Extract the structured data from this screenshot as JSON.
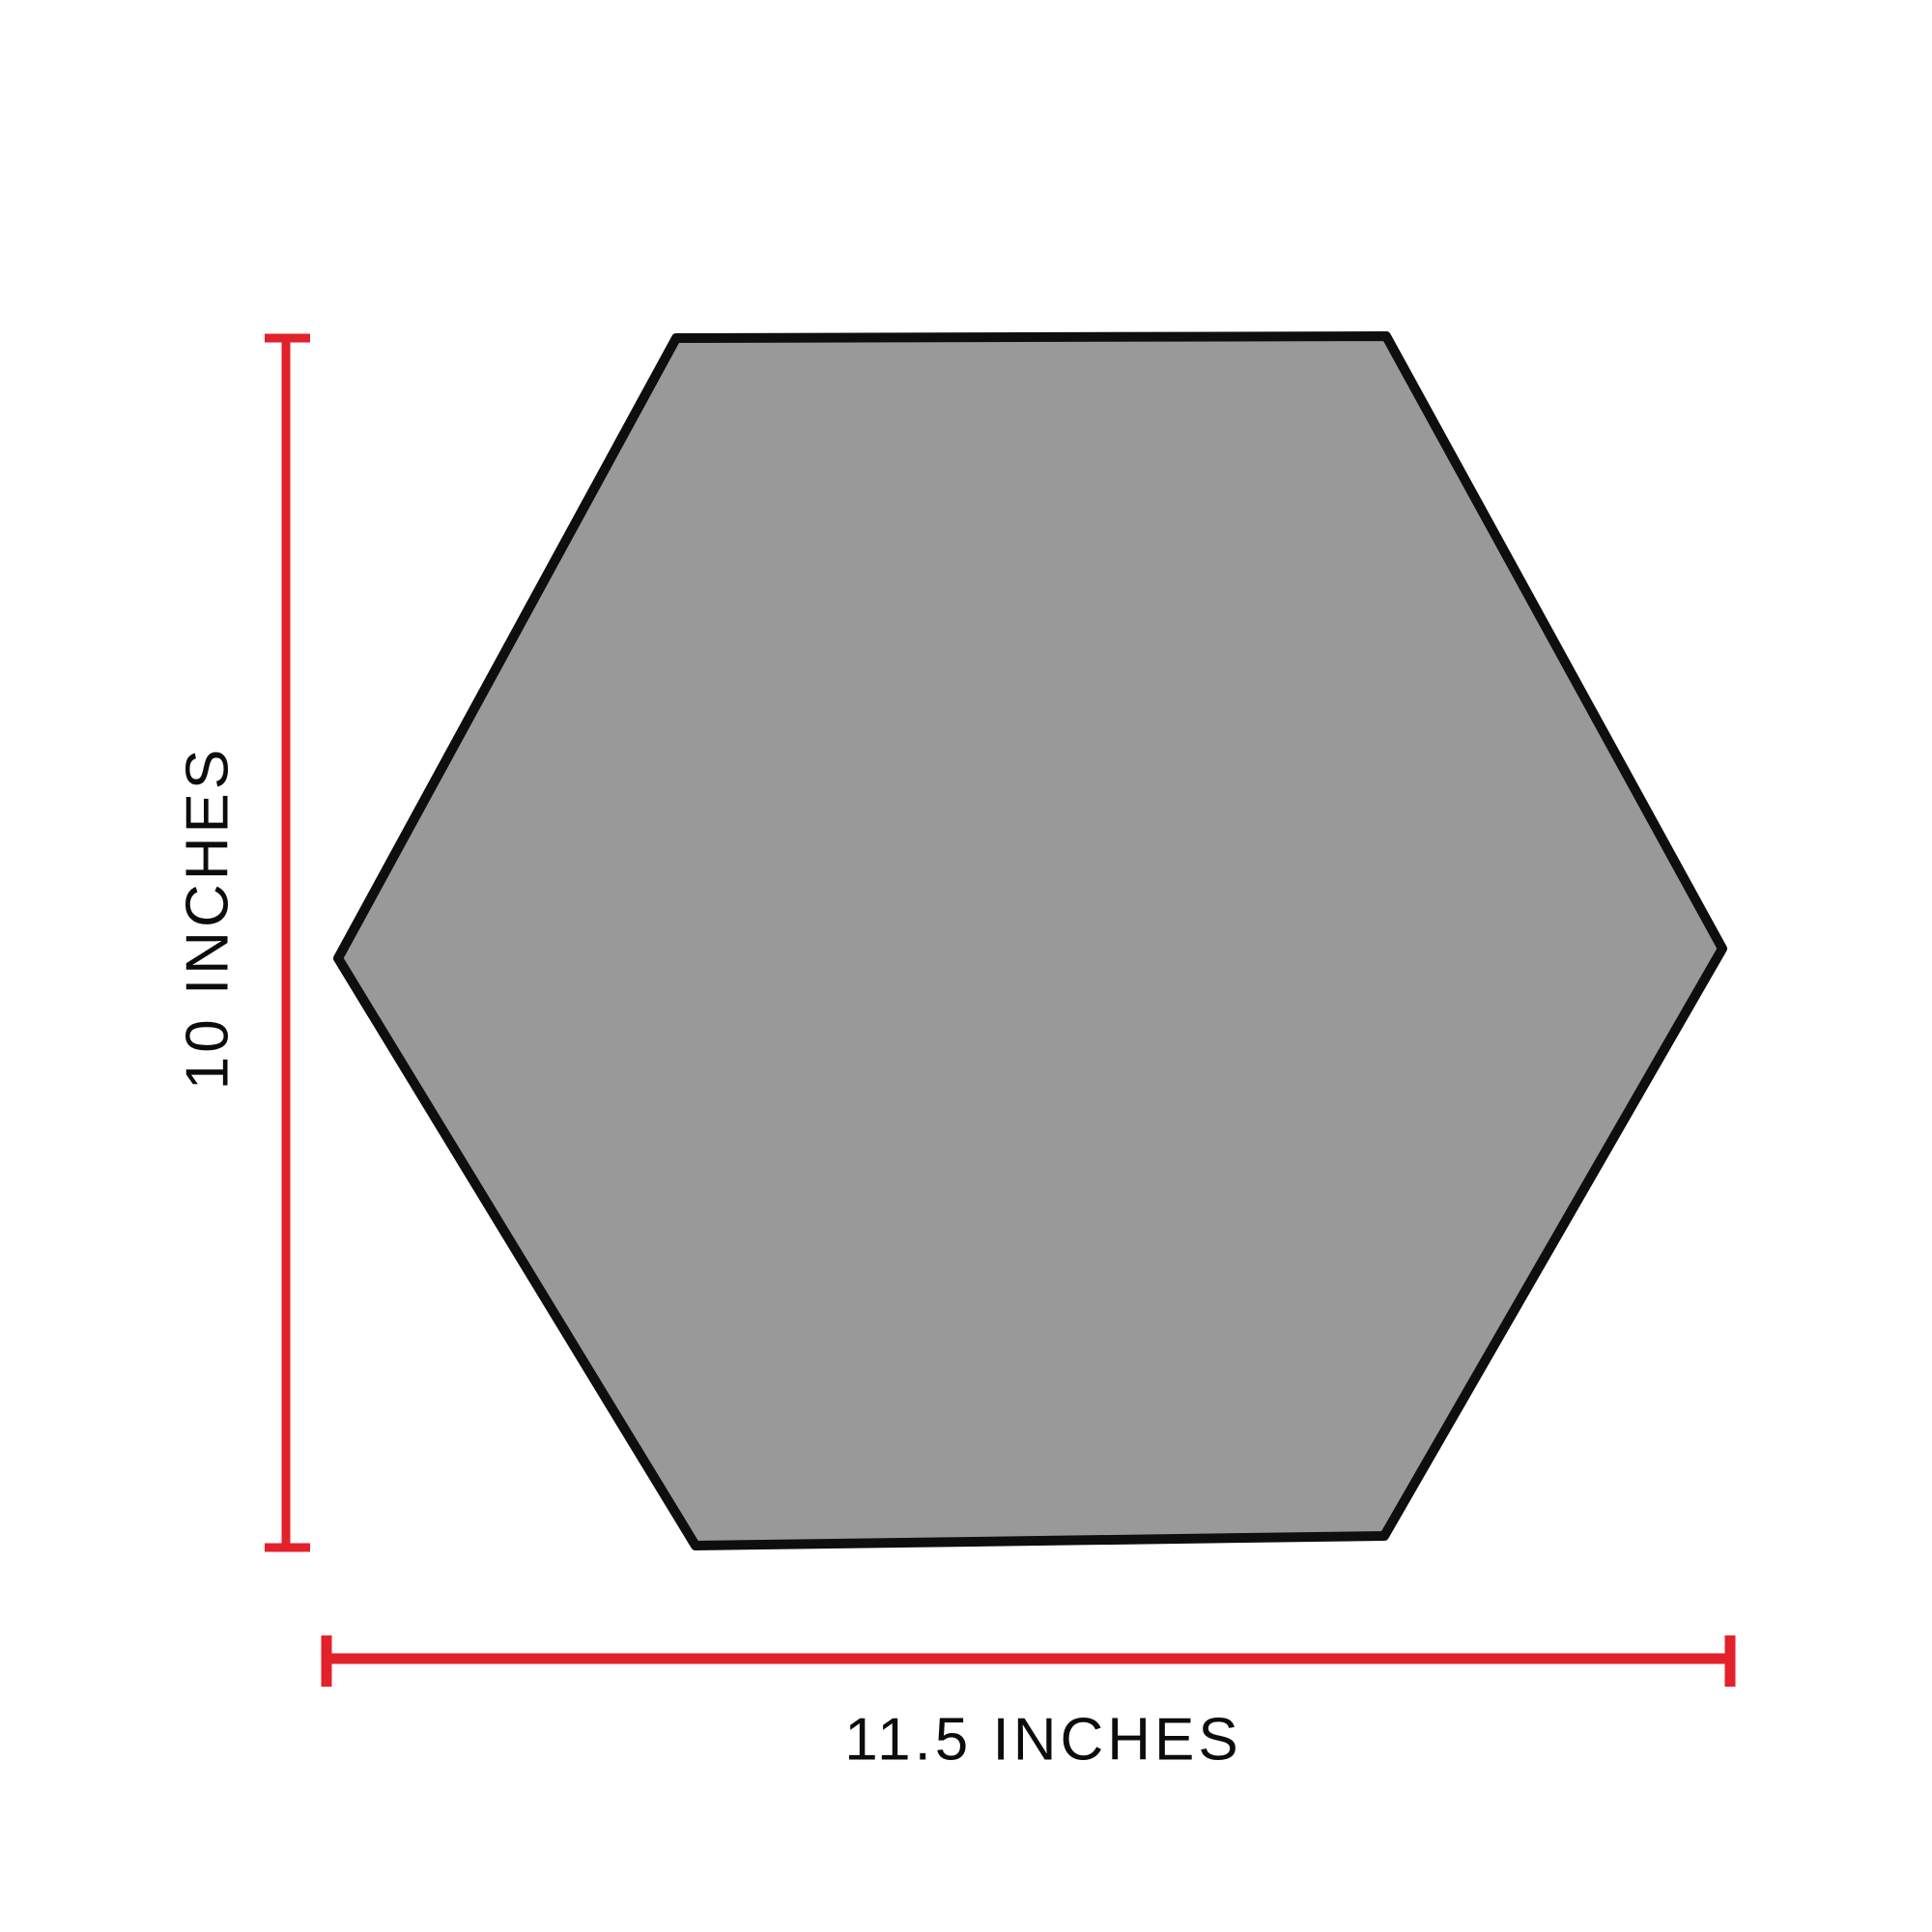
{
  "figure": {
    "shape_name": "hexagon",
    "height_dimension": {
      "label": "10 INCHES",
      "value_inches": 10
    },
    "width_dimension": {
      "label": "11.5 INCHES",
      "value_inches": 11.5
    }
  },
  "colors": {
    "hexagon_fill": "#999999",
    "hexagon_stroke": "#0e0e0e",
    "dimension_line": "#e3212b",
    "label_text": "#0c0c0c",
    "background": "#ffffff"
  }
}
